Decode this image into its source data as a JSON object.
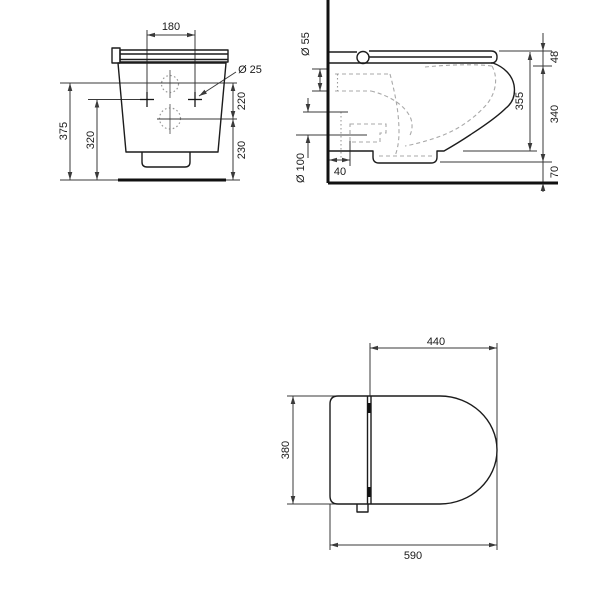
{
  "style": {
    "bg": "#ffffff",
    "outline_color": "#1c1c1c",
    "thick_color": "#111111",
    "dim_color": "#3a3a3a",
    "dashed_color": "#a9a9a9",
    "dotted_color": "#9a9a9a",
    "text_color": "#1a1a1a"
  },
  "views": {
    "front": {
      "label": "front-elevation",
      "texts": [
        {
          "s": "180",
          "x": 171,
          "y": 27,
          "rot": 0
        },
        {
          "s": "Ø 25",
          "x": 250,
          "y": 70,
          "rot": 0
        },
        {
          "s": "220",
          "x": 242,
          "y": 101,
          "rot": -90
        },
        {
          "s": "230",
          "x": 242,
          "y": 150,
          "rot": -90
        },
        {
          "s": "320",
          "x": 91,
          "y": 140,
          "rot": -90
        },
        {
          "s": "375",
          "x": 64,
          "y": 131,
          "rot": -90
        }
      ],
      "lines": [
        [
          147,
          35,
          195,
          35
        ],
        [
          147,
          30,
          147,
          94
        ],
        [
          195,
          30,
          195,
          94
        ],
        [
          70,
          83,
          70,
          180
        ],
        [
          97,
          99.5,
          97,
          180
        ],
        [
          60,
          83,
          237,
          83
        ],
        [
          88,
          99.5,
          150,
          99.5
        ],
        [
          157,
          119,
          237,
          119
        ],
        [
          233,
          83,
          233,
          119
        ],
        [
          233,
          119,
          233,
          180
        ],
        [
          60,
          180,
          240,
          180
        ],
        [
          236,
          72,
          199,
          96
        ]
      ],
      "center_lines": [
        [
          170,
          70,
          170,
          98
        ],
        [
          170,
          104,
          170,
          134
        ]
      ],
      "cross_lines": [
        [
          140,
          99.5,
          154,
          99.5
        ],
        [
          147,
          92,
          147,
          107
        ],
        [
          188,
          99.5,
          202,
          99.5
        ],
        [
          195,
          92,
          195,
          107
        ]
      ],
      "outline_paths": [
        "M112,48 h8 v15 h-8 z",
        "M120,50 h108 v12 h-108 z",
        "M120,54 h108",
        "M120,59.5 h108",
        "M118,63 L226,63 L218,152 L126,152 Z",
        "M142,152 V162 Q142,167 147,167 H185 Q190,167 190,162 V152"
      ],
      "dotted_circles": [
        [
          170,
          84,
          8.5
        ],
        [
          170,
          118.5,
          10.5
        ]
      ],
      "solid_circles": [],
      "dashed_paths": [],
      "dotted_lines": [],
      "thick_lines": [
        [
          118,
          180,
          226,
          180
        ]
      ],
      "arrows": [
        [
          147,
          35,
          180
        ],
        [
          195,
          35,
          0
        ],
        [
          70,
          83,
          -90
        ],
        [
          70,
          180,
          90
        ],
        [
          97,
          99.5,
          -90
        ],
        [
          97,
          180,
          90
        ],
        [
          233,
          83,
          -90
        ],
        [
          233,
          119,
          90
        ],
        [
          233,
          119,
          -90
        ],
        [
          233,
          180,
          90
        ],
        [
          199,
          96,
          147
        ]
      ]
    },
    "side": {
      "label": "side-section",
      "texts": [
        {
          "s": "Ø 55",
          "x": 306,
          "y": 44,
          "rot": -90
        },
        {
          "s": "Ø 100",
          "x": 301,
          "y": 168,
          "rot": -90
        },
        {
          "s": "40",
          "x": 340,
          "y": 172,
          "rot": 0
        },
        {
          "s": "355",
          "x": 520,
          "y": 101,
          "rot": -90
        },
        {
          "s": "48",
          "x": 555,
          "y": 57,
          "rot": -90
        },
        {
          "s": "340",
          "x": 555,
          "y": 114,
          "rot": -90
        },
        {
          "s": "70",
          "x": 555,
          "y": 172,
          "rot": -90
        }
      ],
      "lines": [
        [
          312,
          69,
          329,
          69
        ],
        [
          312,
          91,
          329,
          91
        ],
        [
          320,
          69,
          320,
          91
        ],
        [
          303,
          112,
          348,
          112
        ],
        [
          296,
          135,
          367,
          135
        ],
        [
          308,
          98,
          308,
          112
        ],
        [
          308,
          135,
          308,
          158
        ],
        [
          329,
          160,
          350,
          160
        ],
        [
          350,
          141,
          350,
          166
        ],
        [
          530,
          52,
          530,
          151
        ],
        [
          499,
          51,
          552,
          51
        ],
        [
          463,
          151,
          537,
          151
        ],
        [
          543,
          33,
          543,
          192
        ],
        [
          533,
          66,
          552,
          66
        ],
        [
          440,
          162,
          552,
          162
        ]
      ],
      "center_lines": [],
      "cross_lines": [],
      "outline_paths": [
        "M329,52 H357",
        "M329,63 H493",
        "M369,51 H491",
        "M369,57 H492",
        "M491,51 Q497,51 497,57 Q497,63 491,63",
        "M493,63 C504,67 512,75 514,85 C516,97 511,104 506,108 C495,119 479,129 470,135 C461,141 451,147 444,151 L437,151 L437,157 Q437,163 431,163 L379,163 Q373,163 373,157 L373,151 L329,151"
      ],
      "dotted_circles": [],
      "solid_circles": [
        [
          363,
          57.5,
          6
        ]
      ],
      "dashed_paths": [
        "M335,74 H390",
        "M335,91 H371",
        "M390,74 C395,93 399,112 399,132 C399,143 397,151 395,156",
        "M371,91 C391,96 406,106 411,119 C413,126 412,132 409,137",
        "M425,67 C450,64.5 478,64 492,66",
        "M492,66 C499,79 495,94 487,104 C474,119 457,130 441,136 C430,140 416,144 405,146",
        "M350,124 H386 V133 H380 V142 H350 Z",
        "M379,156 H432"
      ],
      "dotted_lines": [
        [
          337.5,
          74,
          337.5,
          91
        ],
        [
          341,
          112,
          341,
          158
        ]
      ],
      "thick_lines": [
        [
          328,
          0,
          328,
          183
        ],
        [
          328,
          183,
          558,
          183
        ]
      ],
      "arrows": [
        [
          320,
          69,
          -90
        ],
        [
          320,
          91,
          90
        ],
        [
          308,
          112,
          90
        ],
        [
          308,
          135,
          -90
        ],
        [
          329,
          160,
          180
        ],
        [
          350,
          160,
          0
        ],
        [
          530,
          52,
          -90
        ],
        [
          530,
          151,
          90
        ],
        [
          543,
          51,
          90
        ],
        [
          543,
          66,
          -90
        ],
        [
          543,
          162,
          90
        ],
        [
          543,
          183,
          -90
        ]
      ]
    },
    "plan": {
      "label": "plan-view",
      "texts": [
        {
          "s": "440",
          "x": 436,
          "y": 342,
          "rot": 0
        },
        {
          "s": "380",
          "x": 286,
          "y": 450,
          "rot": -90
        },
        {
          "s": "590",
          "x": 413,
          "y": 556,
          "rot": 0
        }
      ],
      "lines": [
        [
          370,
          348,
          497,
          348
        ],
        [
          370,
          343,
          370,
          396
        ],
        [
          497,
          343,
          497,
          550
        ],
        [
          293,
          396,
          293,
          504
        ],
        [
          287,
          396,
          336,
          396
        ],
        [
          287,
          504,
          336,
          504
        ],
        [
          330,
          545,
          497,
          545
        ],
        [
          330,
          504,
          330,
          550
        ]
      ],
      "center_lines": [],
      "cross_lines": [],
      "outline_paths": [
        "M338,396 L440,396 C471,396 497,420 497,450 C497,480 471,504 440,504 L338,504 Q330,504 330,496 L330,404 Q330,396 338,396 Z",
        "M367.5,396 V504",
        "M371,396 V504",
        "M357,504 V512 H368 V504"
      ],
      "dotted_circles": [],
      "solid_circles": [],
      "dashed_paths": [],
      "dotted_lines": [],
      "thick_lines": [
        [
          369,
          403,
          369,
          413
        ],
        [
          369,
          487,
          369,
          497
        ]
      ],
      "arrows": [
        [
          370,
          348,
          180
        ],
        [
          497,
          348,
          0
        ],
        [
          293,
          396,
          -90
        ],
        [
          293,
          504,
          90
        ],
        [
          330,
          545,
          180
        ],
        [
          497,
          545,
          0
        ]
      ]
    }
  }
}
